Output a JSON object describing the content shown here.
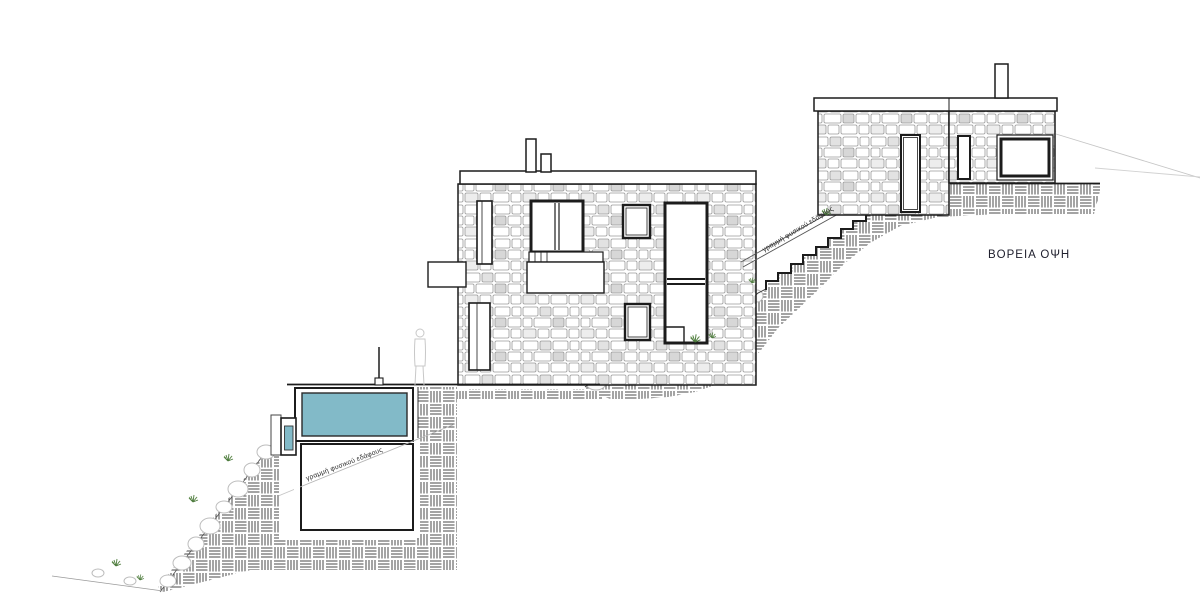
{
  "drawing": {
    "title": "ΒΟΡΕΙΑ ΟΨΗ",
    "ground_line_label_stairs": "γραμμή φυσικού εδάφους",
    "ground_line_label_pool": "γραμμή φυσικού εδάφους"
  },
  "colors": {
    "pool_water": "#82bac8",
    "ink": "#1c1c1c",
    "stone_outline": "#9a9a9a",
    "hatch_line": "#4a4a4a",
    "faint_line": "#c6c6c6",
    "rock_outline": "#bdbdbd",
    "plant_green": "#4e7c3e",
    "title_color": "#20202e"
  }
}
